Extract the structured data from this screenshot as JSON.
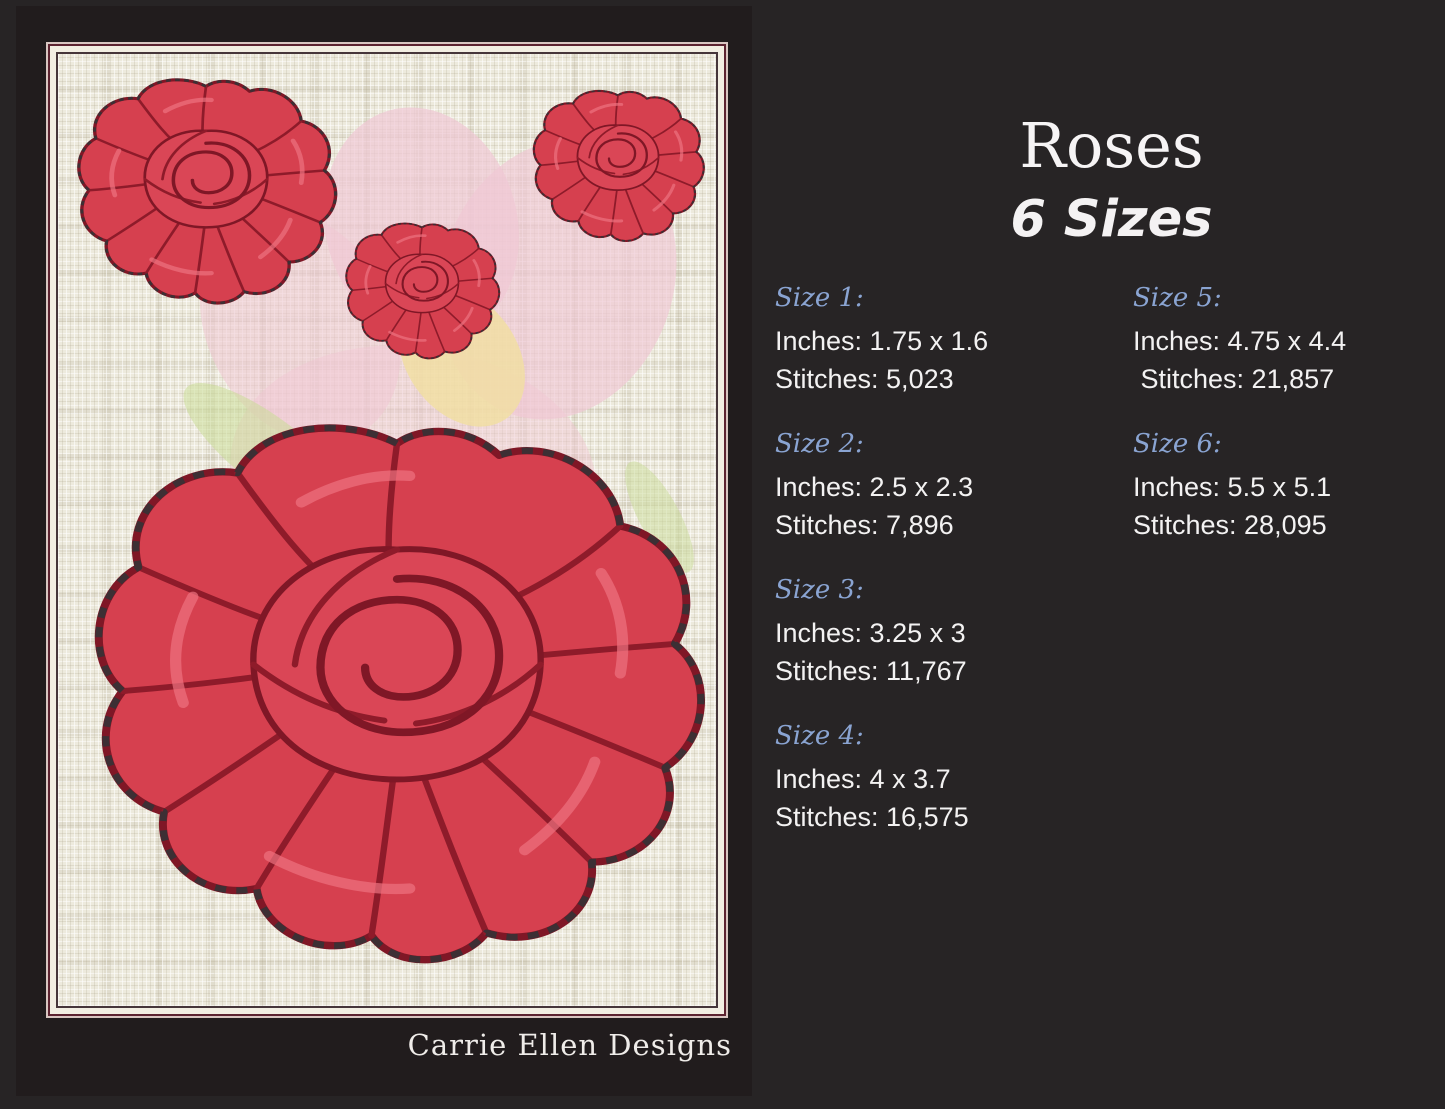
{
  "page": {
    "background_color": "#272425",
    "photo_background_color": "#211c1d",
    "frame_border_color": "#5c2330",
    "linen_color": "#edeadd"
  },
  "preview": {
    "signature": "Carrie Ellen Designs",
    "rose_colors": {
      "fill": "#d6404f",
      "highlight": "#ee7280",
      "shadow_line": "#8e1b2a",
      "outline": "#7f1726",
      "stitch_dots": "#3d2f34"
    },
    "watermark_colors": {
      "pink": "#f0c7d4",
      "yellow": "#f1dfa0",
      "green": "#cadc97"
    }
  },
  "details": {
    "title": "Roses",
    "subtitle": "6 Sizes",
    "accent_color": "#8aa4d2",
    "sizes": [
      {
        "label": "Size 1:",
        "inches": "Inches: 1.75 x 1.6",
        "stitches": "Stitches: 5,023"
      },
      {
        "label": "Size 2:",
        "inches": "Inches: 2.5 x 2.3",
        "stitches": "Stitches: 7,896"
      },
      {
        "label": "Size 3:",
        "inches": "Inches: 3.25 x 3",
        "stitches": "Stitches: 11,767"
      },
      {
        "label": "Size 4:",
        "inches": "Inches: 4 x 3.7",
        "stitches": "Stitches: 16,575"
      },
      {
        "label": "Size 5:",
        "inches": "Inches: 4.75 x 4.4",
        "stitches": " Stitches: 21,857"
      },
      {
        "label": "Size 6:",
        "inches": "Inches: 5.5 x 5.1",
        "stitches": "Stitches: 28,095"
      }
    ]
  }
}
